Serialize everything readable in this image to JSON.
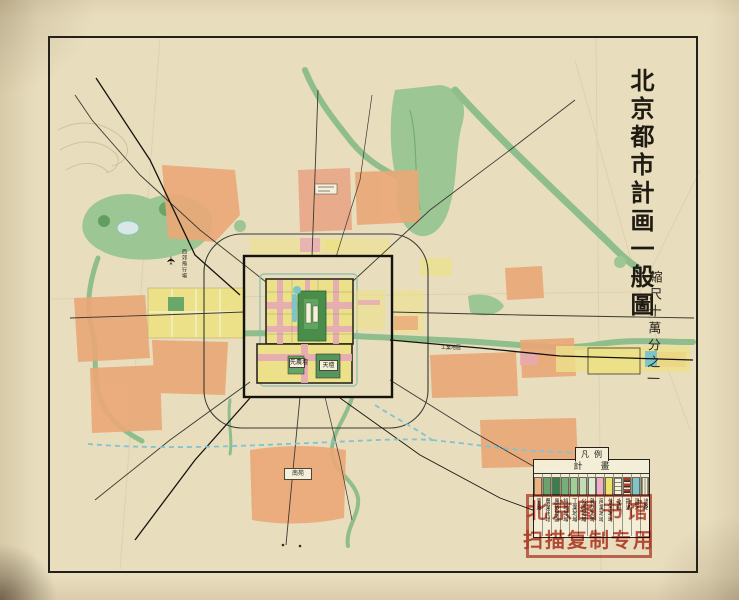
{
  "title": {
    "text": "北京都市計画一般圖",
    "scale": "縮尺十萬分之一"
  },
  "legend": {
    "tab": "凡例",
    "header": "計畫",
    "items": [
      {
        "label": "官廳",
        "color": "#efb27b",
        "pattern": "solid"
      },
      {
        "label": "農業用地",
        "color": "#69a56b",
        "pattern": "solid"
      },
      {
        "label": "風致地區",
        "color": "#35804b",
        "pattern": "solid"
      },
      {
        "label": "緑地地域",
        "color": "#74b178",
        "pattern": "solid"
      },
      {
        "label": "工業地域",
        "color": "#9ecf97",
        "pattern": "solid"
      },
      {
        "label": "公園地域",
        "color": "#c0ddb6",
        "pattern": "solid"
      },
      {
        "label": "雜居地域",
        "color": "#dcebd2",
        "pattern": "solid"
      },
      {
        "label": "商業地域",
        "color": "#f0aec6",
        "pattern": "solid"
      },
      {
        "label": "住宅地域",
        "color": "#efe268",
        "pattern": "solid"
      },
      {
        "label": "水面",
        "color": "#f6f1dc",
        "pattern": "ticks"
      },
      {
        "label": "鐵道",
        "color": "",
        "pattern": "rail"
      },
      {
        "label": "運河",
        "color": "#7cc5c8",
        "pattern": "solid"
      },
      {
        "label": "道路",
        "color": "",
        "pattern": "hatch"
      }
    ]
  },
  "stamp": {
    "line1": "北京图书馆",
    "line2": "扫描复制专用",
    "color": "#bd4334"
  },
  "map_labels": [
    {
      "text": "西郊飛行場",
      "x": 181,
      "y": 249,
      "w": 8,
      "h": 32,
      "vertical": true,
      "box": false
    },
    {
      "text": "南苑",
      "x": 284,
      "y": 468,
      "w": 26,
      "h": 10,
      "vertical": false,
      "box": true
    },
    {
      "text": "天壇",
      "x": 319,
      "y": 360,
      "w": 17,
      "h": 9,
      "vertical": false,
      "box": true
    },
    {
      "text": "先農壇",
      "x": 289,
      "y": 358,
      "w": 14,
      "h": 8,
      "vertical": false,
      "box": true
    },
    {
      "text": "工業地區",
      "x": 441,
      "y": 346,
      "w": 26,
      "h": 7,
      "vertical": false,
      "box": false
    }
  ],
  "colors": {
    "paper": "#e8ddbd",
    "frame": "#22201a",
    "river_green": "#8fbe8c",
    "park_green": "#4a8c4a",
    "district_orange": "#eaa877",
    "district_yellow": "#ece189",
    "commercial_pink": "#e7a9b7",
    "canal_teal": "#7cc5c8",
    "stamp_red": "#bd4334"
  }
}
